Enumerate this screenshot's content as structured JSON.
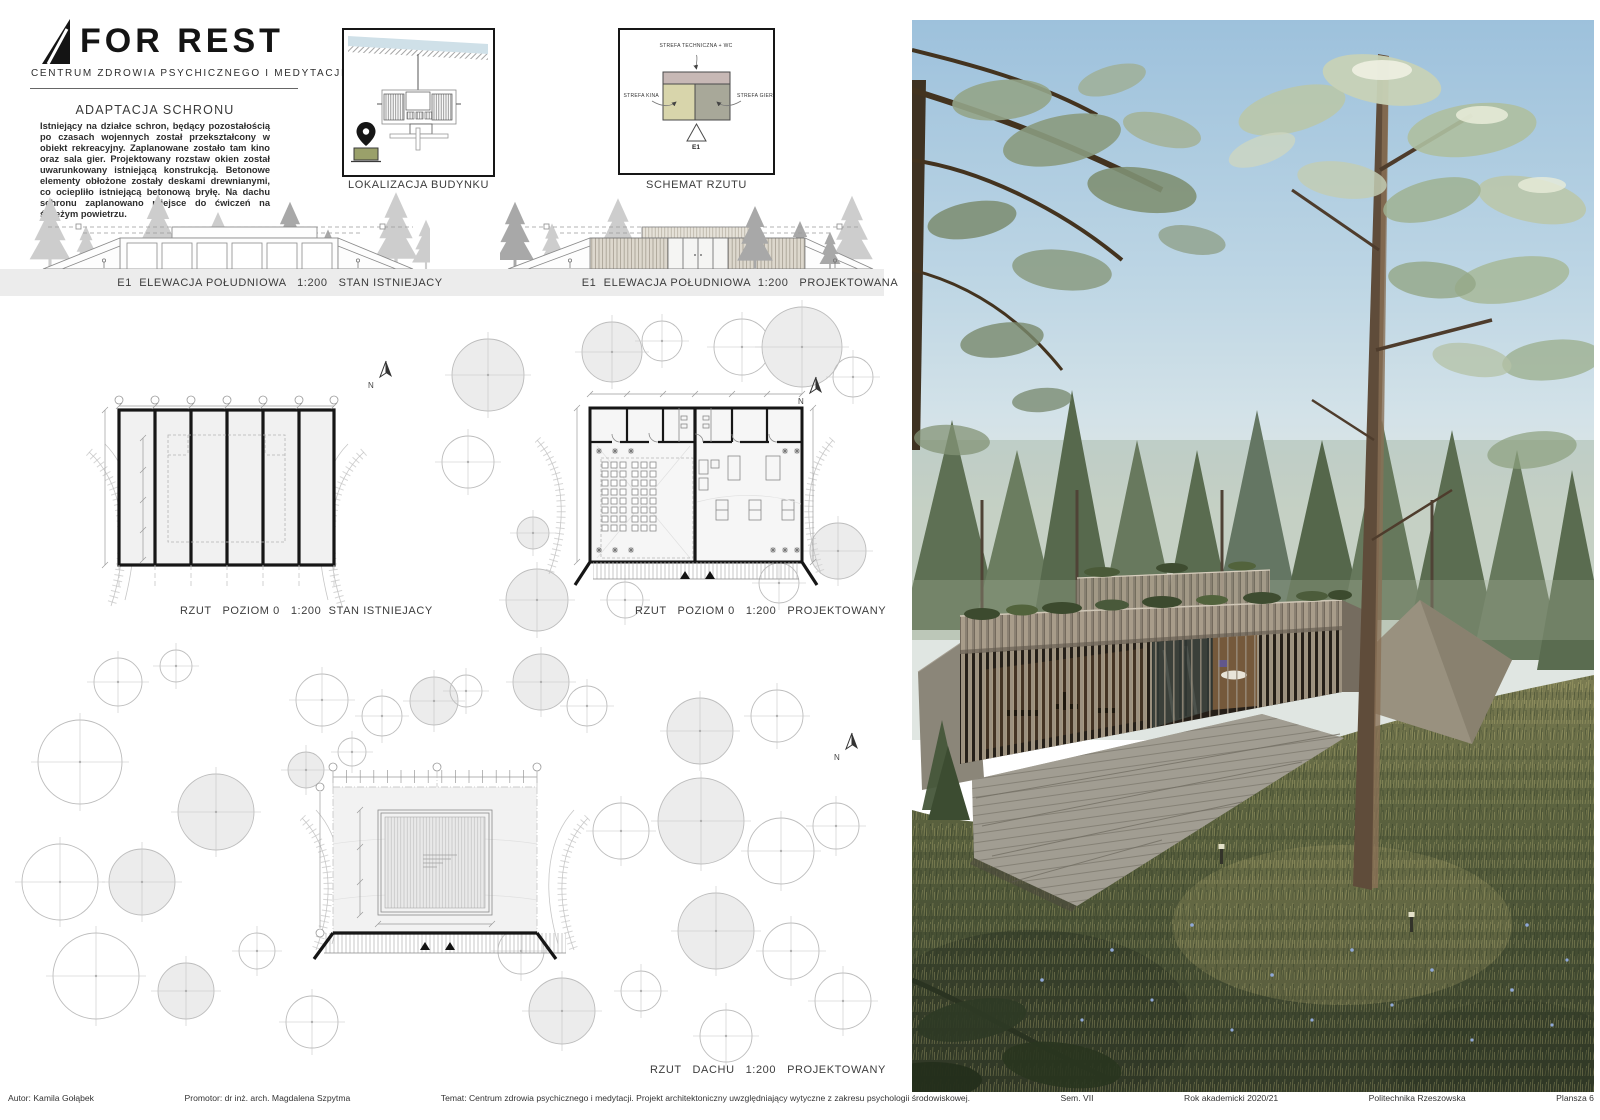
{
  "logo": {
    "title": "FOR REST",
    "subtitle": "CENTRUM ZDROWIA PSYCHICZNEGO I MEDYTACJI"
  },
  "intro": {
    "heading": "ADAPTACJA SCHRONU",
    "body": "Istniejący na działce schron, będący pozostałością po czasach wojennych został przekształcony w obiekt rekreacyjny. Zaplanowane zostało tam kino oraz sala gier. Projektowany rozstaw okien został uwarunkowany istniejącą konstrukcją. Betonowe elementy obłożone zostały deskami drewnianymi, co ociepliło istniejącą betonową bryłę. Na dachu schronu zaplanowano miejsce do ćwiczeń na świeżym powietrzu."
  },
  "location": {
    "caption": "LOKALIZACJA BUDYNKU"
  },
  "schema": {
    "caption": "SCHEMAT RZUTU",
    "zone_technical": "STREFA TECHNICZNA + WC",
    "zone_cinema": "STREFA KINA",
    "zone_games": "STREFA GIER",
    "section_marker": "E1",
    "colors": {
      "technical": "#c7b8b5",
      "cinema": "#d8d5ab",
      "games": "#a8a899"
    }
  },
  "elevations": {
    "existing_caption": "E1  ELEWACJA POŁUDNIOWA   1:200   STAN ISTNIEJACY",
    "proposed_caption": "E1  ELEWACJA POŁUDNIOWA  1:200   PROJEKTOWANA"
  },
  "plans": {
    "existing_caption": "RZUT   POZIOM 0   1:200  STAN ISTNIEJACY",
    "proposed_caption": "RZUT   POZIOM 0   1:200   PROJEKTOWANY",
    "roof_caption": "RZUT   DACHU   1:200   PROJEKTOWANY",
    "north_label": "N"
  },
  "render": {
    "palette": {
      "sky": "#9dc1dc",
      "foliage": "#6b7d60",
      "wood": "#978b7a",
      "grass": "#4e5538"
    }
  },
  "footer": {
    "segments": [
      "Autor: Kamila Gołąbek",
      "Promotor: dr inż. arch. Magdalena Szpytma",
      "Temat: Centrum zdrowia psychicznego i medytacji. Projekt architektoniczny uwzględniający wytyczne z zakresu psychologii środowiskowej.",
      "Sem. VII",
      "Rok akademicki 2020/21",
      "Politechnika Rzeszowska",
      "Plansza 6"
    ]
  }
}
